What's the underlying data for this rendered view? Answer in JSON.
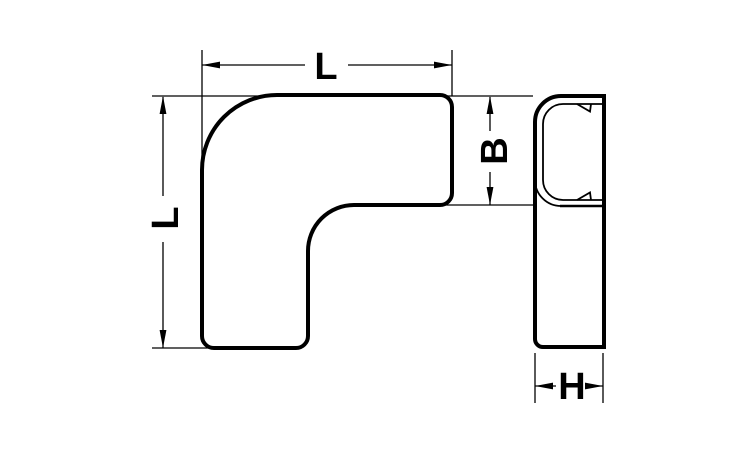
{
  "drawing": {
    "labels": {
      "length_horizontal": "L",
      "length_vertical": "L",
      "width_b": "B",
      "depth_h": "H"
    },
    "colors": {
      "line": "#000000",
      "background": "#ffffff"
    }
  }
}
